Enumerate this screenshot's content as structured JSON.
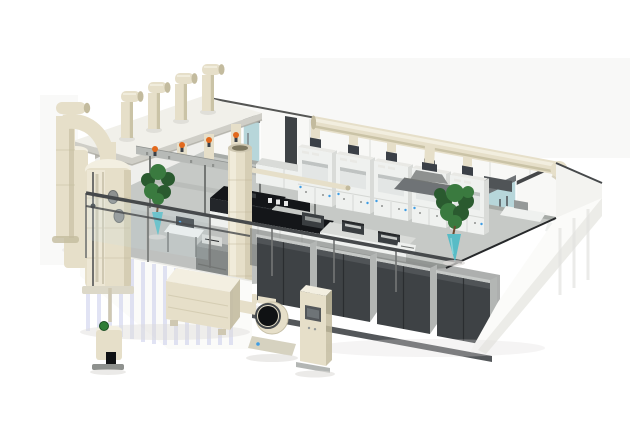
{
  "scene": {
    "title": "3D cutaway rendering of a laboratory with exhaust ventilation system",
    "type": "isometric-3d-render",
    "background": "#ffffff",
    "objects": {
      "roof_exhaust_stubs": 4,
      "duct_dampers": 4,
      "fume_hoods": 5,
      "storage_cabinet_groups": 4,
      "glass_doors": 2,
      "potted_plants": 2,
      "scrubber_towers": 2,
      "exhaust_stack": 1,
      "exhaust_fan": 1,
      "silencer_box": 1,
      "control_pedestal": 1,
      "supply_diffuser": 1,
      "island_benches": 2,
      "instrument_benches": 2,
      "bench_instruments": 3
    },
    "palette": {
      "haze": "#ededea",
      "roofTop": "#f1f0ea",
      "roofFascia": "#cfcec7",
      "roofShadow": "#a8a69e",
      "wall": "#f8f8f6",
      "wallShade": "#e9e9e5",
      "leftWall": "#efefec",
      "wallLine": "#555654",
      "duct": "#e6dfc9",
      "ductLight": "#f3efe1",
      "ductDark": "#c3bb9e",
      "collar": "#3b4047",
      "glass": "#b7d6da",
      "glassHint": "#cfe3e8",
      "doorFrame": "#6f7376",
      "floor": "#c6c9c6",
      "floorShade": "#b4b7b4",
      "rack": "#b7bab7",
      "rackDark": "#8e918e",
      "post": "#737674",
      "orange": "#e2691d",
      "blue": "#3f9de4",
      "benchBlack": "#141619",
      "benchFront": "#23262a",
      "benchWhite": "#eff1ef",
      "benchSide": "#d9dbd8",
      "equipDark": "#3a3e41",
      "equipGray": "#959998",
      "shelfGray": "#848887",
      "cabDark": "#3e4245",
      "cabLight": "#505457",
      "cabFrame": "#c6c9c7",
      "cabSide": "#b3b6b4",
      "railDark": "#46494b",
      "cutLine": "#26282a",
      "slab": "#fbfbf9",
      "stripe": "#c9cdec",
      "wedgeStripe": "#e3e3df",
      "shadow": "#dedcd9",
      "green": "#3a7a3f",
      "greenDark": "#2a5a2f",
      "vase": "#58bcc6",
      "trunk": "#6b4a2f",
      "baseStrip": "#54575a",
      "seam": "#d5d7d4",
      "pipe": "#cfc8b2",
      "openGray": "#e3e6e5",
      "openShadow": "#bfc3c2",
      "portGray": "#8e9190",
      "greenCap": "#2e7d36",
      "inlet": "#101214",
      "screen": "#53575a",
      "white": "#ffffff"
    }
  }
}
